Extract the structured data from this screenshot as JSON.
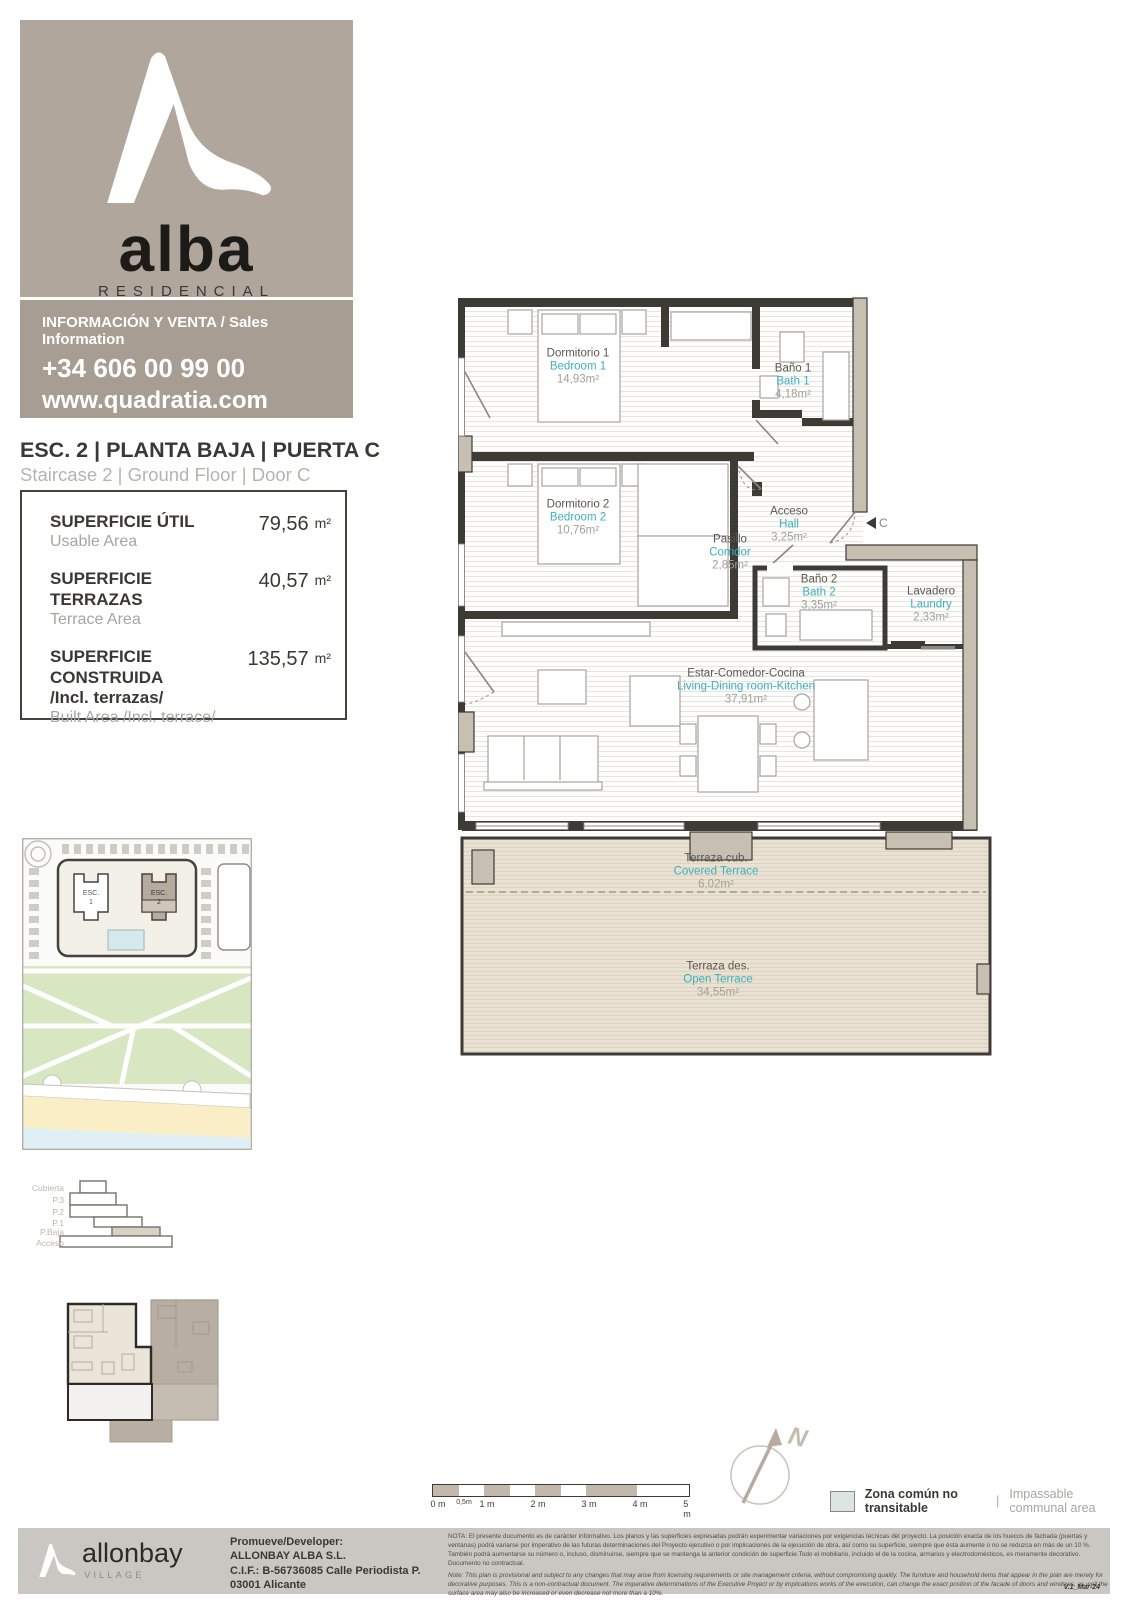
{
  "colors": {
    "accent_teal": "#3cb0c0",
    "taupe_brand": "#b0a69b",
    "taupe_dark": "#a79d92",
    "wall": "#3e3b36",
    "terrace_fill": "#e9e1d2",
    "legend_fill": "#dbe5e1"
  },
  "brand": {
    "name": "alba",
    "subtitle": "RESIDENCIAL",
    "sales_label": "INFORMACIÓN Y VENTA / Sales Information",
    "phone": "+34 606 00 99 00",
    "website": "www.quadratia.com"
  },
  "unit": {
    "title_es": "ESC. 2 | PLANTA BAJA | PUERTA C",
    "title_en": "Staircase 2 | Ground Floor | Door C"
  },
  "areas": {
    "rows": [
      {
        "label": "SUPERFICIE ÚTIL",
        "sub": "Usable Area",
        "value": "79,56",
        "unit": "m²"
      },
      {
        "label": "SUPERFICIE TERRAZAS",
        "sub": "Terrace Area",
        "value": "40,57",
        "unit": "m²"
      },
      {
        "label": "SUPERFICIE CONSTRUIDA",
        "label2": "/Incl. terrazas/",
        "sub": "Built Area /Incl. terrace/",
        "value": "135,57",
        "unit": "m²"
      }
    ]
  },
  "rooms": [
    {
      "name_es": "Dormitorio 1",
      "name_en": "Bedroom 1",
      "area": "14,93m²"
    },
    {
      "name_es": "Baño 1",
      "name_en": "Bath 1",
      "area": "4,18m²"
    },
    {
      "name_es": "Dormitorio 2",
      "name_en": "Bedroom 2",
      "area": "10,76m²"
    },
    {
      "name_es": "Pasillo",
      "name_en": "Corridor",
      "area": "2,85m²"
    },
    {
      "name_es": "Acceso",
      "name_en": "Hall",
      "area": "3,25m²"
    },
    {
      "name_es": "Baño 2",
      "name_en": "Bath 2",
      "area": "3,35m²"
    },
    {
      "name_es": "Lavadero",
      "name_en": "Laundry",
      "area": "2,33m²"
    },
    {
      "name_es": "Estar-Comedor-Cocina",
      "name_en": "Living-Dining room-Kitchen",
      "area": "37,91m²"
    },
    {
      "name_es": "Terraza cub.",
      "name_en": "Covered Terrace",
      "area": "6,02m²"
    },
    {
      "name_es": "Terraza des.",
      "name_en": "Open Terrace",
      "area": "34,55m²"
    }
  ],
  "plan": {
    "door_marker": "C",
    "north_label": "N"
  },
  "site_map": {
    "building1_label": "ESC.",
    "building1_number": "1",
    "building2_label": "ESC.",
    "building2_number": "2"
  },
  "section": {
    "levels": [
      "Cubierta",
      "P.3",
      "P.2",
      "P.1",
      "P.Baja",
      "Acceso"
    ]
  },
  "scale_bar": {
    "labels": [
      "0 m",
      "0,5m",
      "1 m",
      "2 m",
      "3 m",
      "4 m",
      "5 m"
    ]
  },
  "legend": {
    "label_es": "Zona común no transitable",
    "sep": "|",
    "label_en": "Impassable communal area"
  },
  "footer": {
    "logo_name": "allonbay",
    "logo_sub": "VILLAGE",
    "dev_l1": "Promueve/Developer:",
    "dev_l2": "ALLONBAY ALBA S.L.",
    "dev_l3": "C.I.F.: B-56736085 Calle Periodista P.",
    "dev_l4": "03001 Alicante",
    "nota_es": "NOTA:  El presente documento es de carácter informativo. Los planos y las superficies expresadas podrán experimentar variaciones por exigencias técnicas del proyecto. La posición exacta de los huecos de fachada (puertas y ventanas) podrá variarse por imperativo de las futuras determinaciones del Proyecto ejecutivo o por implicaciones de la ejecución de obra, así como su superficie, siempre que ésta aumente o no se reduzca en más de un 10 %. También podrá aumentarse su número o, incluso, disminuirse, siempre que se mantenga la anterior condición de superficie.Todo el mobiliario, incluido el de la cocina, armarios y electrodomésticos, es meramente decorativo. Documento no contractual.",
    "nota_en": "Note: This plan is provisional and subject to any changes that may arise from licensing requirements or site management criteria, without compromising quality. The furniture and household items that appear in the plan are merely for decorative purposes. This is a non-contractual document. The imperative determinations of the Executive Project or by implications works of the execution, can change the exact position of the facade of doors and windows, as well the surface area may also be increased or even decrease not more than a 10%.",
    "version": "V.1_Mar-24"
  }
}
